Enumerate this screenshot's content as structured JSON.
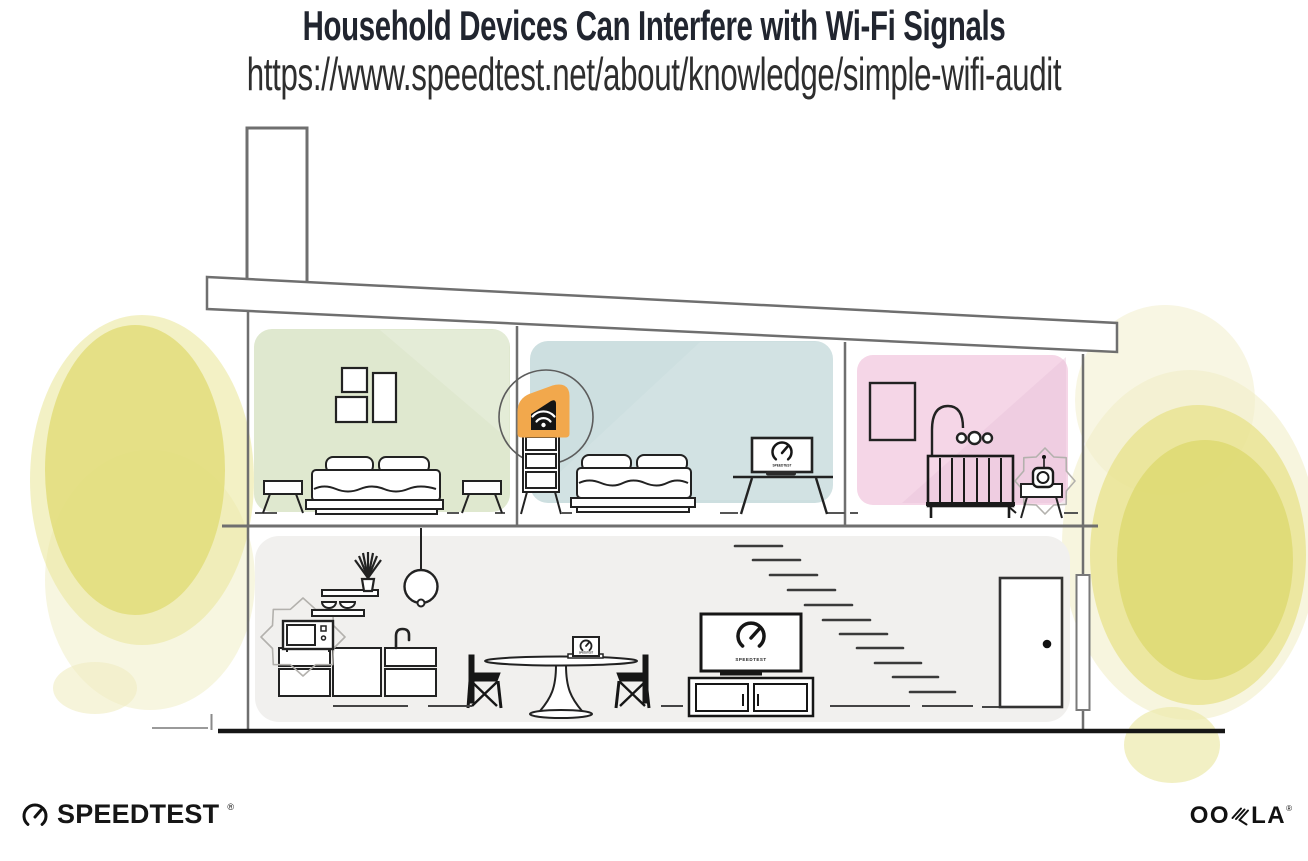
{
  "header": {
    "title": "Household Devices Can Interfere with Wi-Fi Signals",
    "url": "https://www.speedtest.net/about/knowledge/simple-wifi-audit"
  },
  "footer": {
    "speedtest": {
      "label": "SPEEDTEST",
      "trademark": "®"
    },
    "ookla": {
      "label": "OOKLA",
      "left": "OO",
      "right": "LA",
      "trademark": "®"
    }
  },
  "illustration": {
    "scene": "cutaway-two-story-house",
    "highlighted_device": "wifi-router-on-dresser",
    "interference_sources": [
      "microwave-oven",
      "baby-monitor"
    ],
    "screen_labels": {
      "tv": "SPEEDTEST",
      "desk_laptop": "SPEEDTEST",
      "dining_laptop": "SPEEDTEST"
    },
    "rooms": [
      {
        "name": "bedroom-green",
        "wall_color": "#dfe8cf"
      },
      {
        "name": "bedroom-blue",
        "wall_color": "#cddfe0"
      },
      {
        "name": "nursery-pink",
        "wall_color": "#f5d6e7"
      },
      {
        "name": "ground-floor",
        "wall_color": "#f1f0ee"
      }
    ],
    "accent_colors": {
      "router_orange": "#f2a84c",
      "foliage_yellow": "#e4df7d"
    }
  }
}
